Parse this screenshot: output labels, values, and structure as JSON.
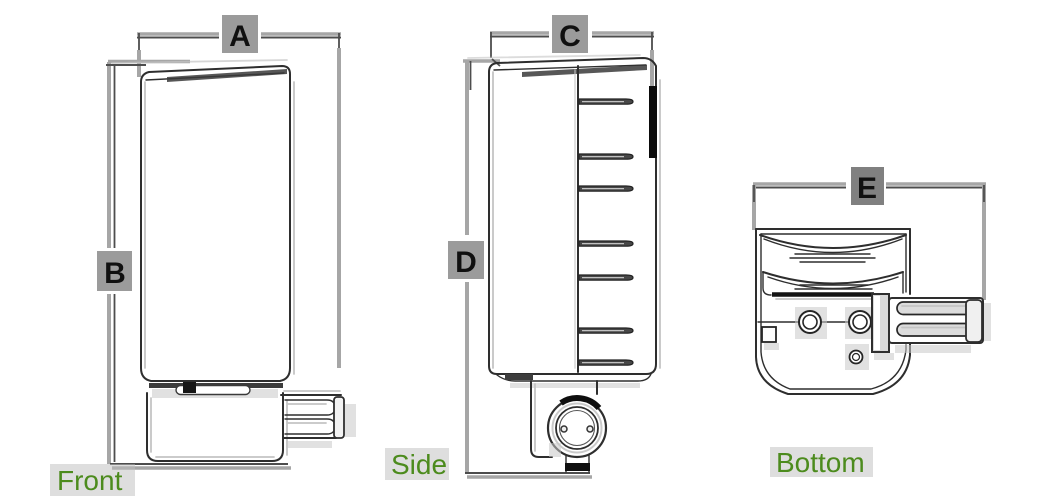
{
  "title": "Product orthographic dimension drawing",
  "colors": {
    "background": "#ffffff",
    "outline_dark": "#2e2e2e",
    "dimension_gray": "#a6a6a6",
    "dimension_dark": "#4d4d4d",
    "label_block_gray": "#8d8d8d",
    "dimension_letter": "#101010",
    "view_label_green": "#4c8b1d"
  },
  "views": [
    {
      "id": "front",
      "label": "Front",
      "dimensions": [
        "A",
        "B"
      ]
    },
    {
      "id": "side",
      "label": "Side",
      "dimensions": [
        "C",
        "D"
      ]
    },
    {
      "id": "bottom",
      "label": "Bottom",
      "dimensions": [
        "E"
      ]
    }
  ],
  "dimension_labels": {
    "A": "A",
    "B": "B",
    "C": "C",
    "D": "D",
    "E": "E"
  }
}
